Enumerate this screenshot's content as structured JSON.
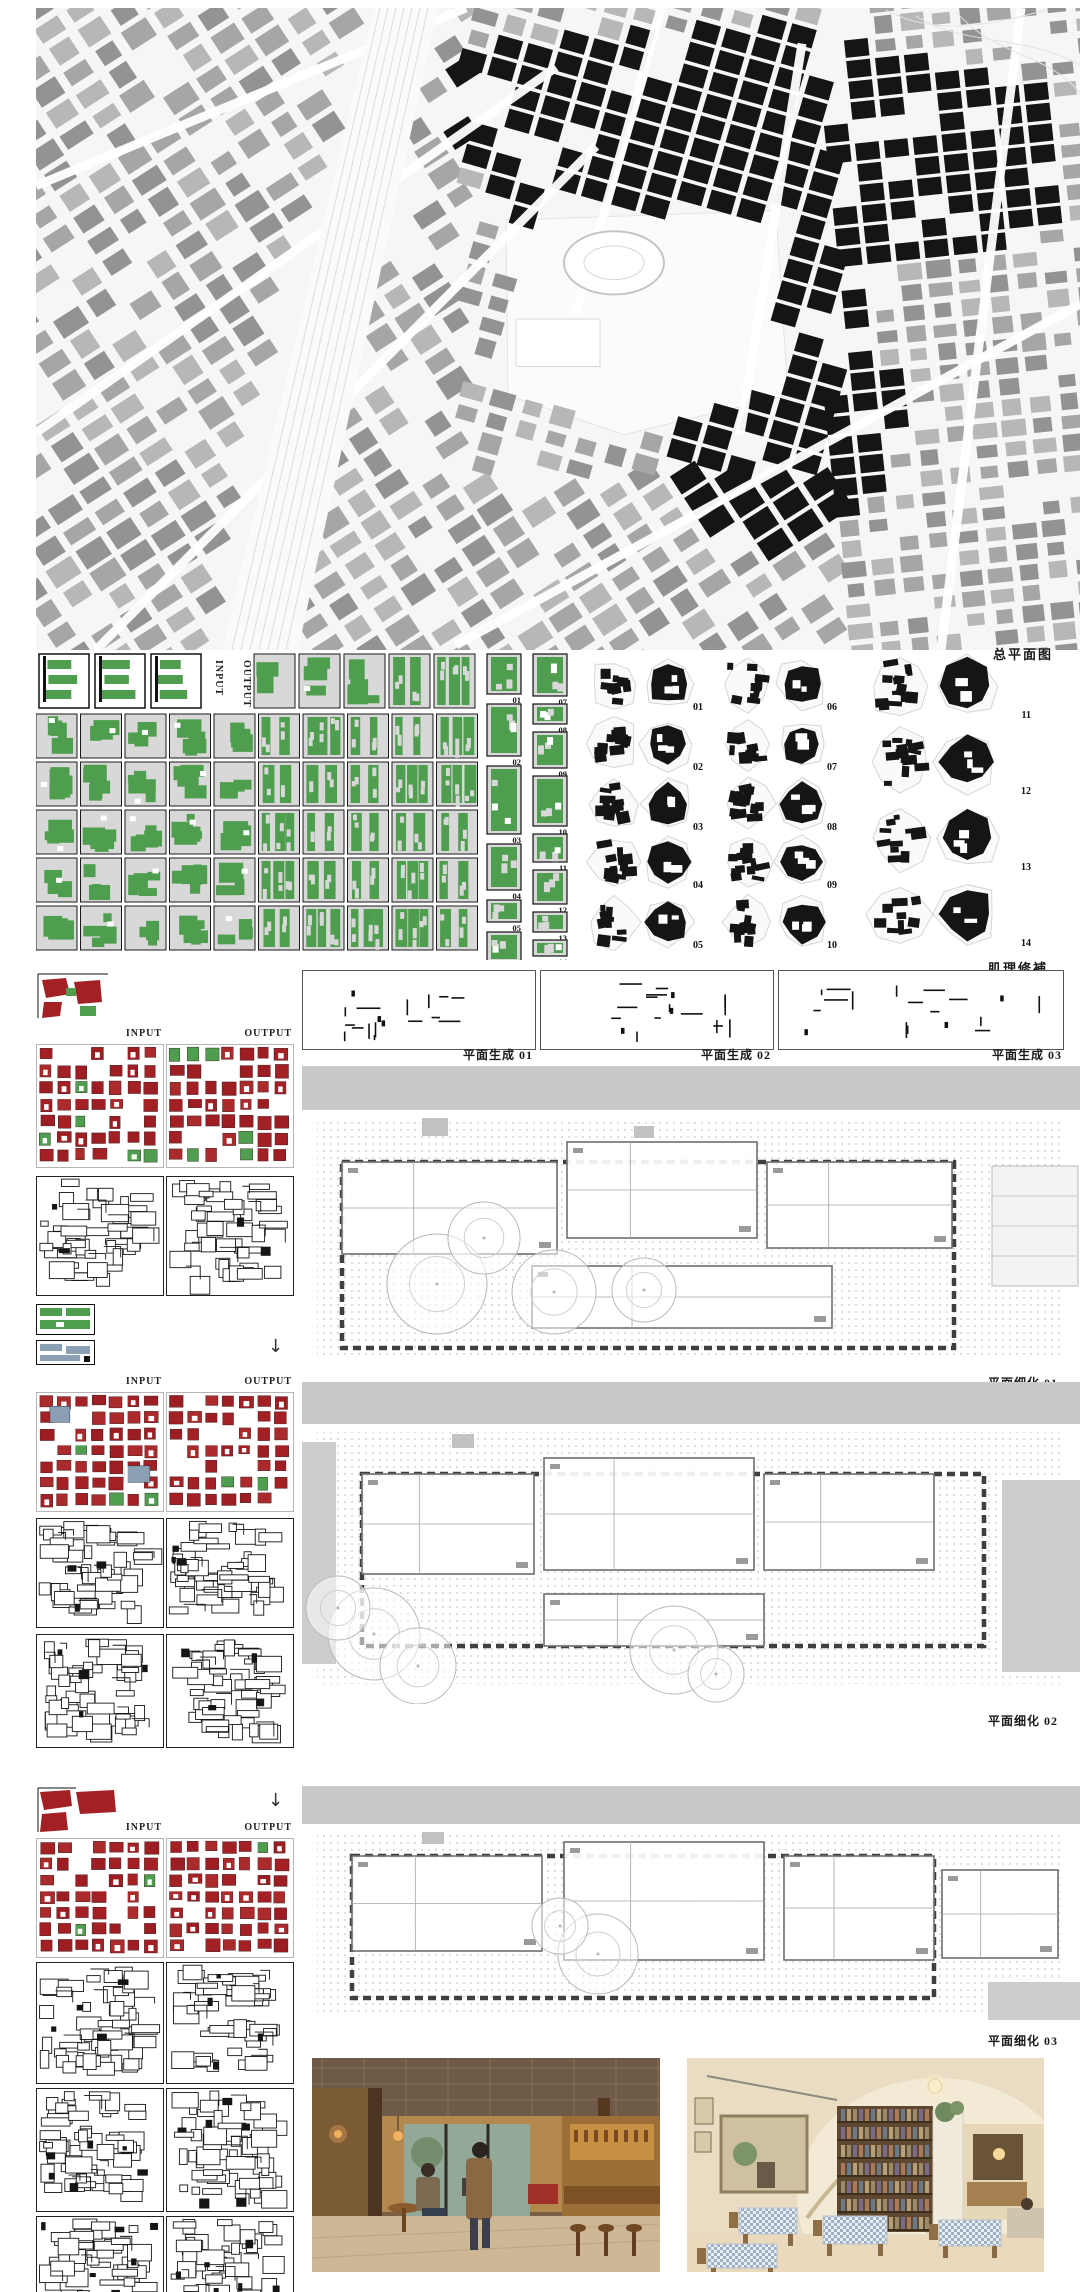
{
  "board": {
    "map": {
      "label": "总平面图"
    },
    "texture_repair": {
      "label": "肌理修補",
      "input_label": "INPUT",
      "output_label": "OUTPUT",
      "strip_numbers": [
        "01",
        "02",
        "03",
        "04",
        "05",
        "06",
        "07",
        "08",
        "09",
        "10",
        "11",
        "12",
        "13",
        "14"
      ],
      "cluster_numbers": [
        "01",
        "02",
        "03",
        "04",
        "05",
        "06",
        "07",
        "08",
        "09",
        "10",
        "11",
        "12",
        "13",
        "14"
      ]
    },
    "plan_generation": {
      "labels": [
        "平面生成 01",
        "平面生成 02",
        "平面生成 03"
      ]
    },
    "refinement_groups": {
      "input_label": "INPUT",
      "output_label": "OUTPUT",
      "arrow_glyph": "↓"
    },
    "plan_refinement": {
      "labels": [
        "平面细化 01",
        "平面细化 02",
        "平面细化 03"
      ]
    },
    "photos": [
      {
        "description": "Warm wood-panelled cafe interior with coffered ceiling, two people talking, bar counter with stools and street window"
      },
      {
        "description": "Vaulted bookshop cafe interior with bookshelves, checked tablecloth tables and warm lighting"
      }
    ],
    "colors": {
      "green": "#4f9e4f",
      "red": "#a32125",
      "dark": "#151515",
      "block_gray": "#a9a9a9",
      "cell_gray": "#d8d8d8",
      "band_gray": "#c9c9c9",
      "slate": "#8ba0b5"
    }
  }
}
